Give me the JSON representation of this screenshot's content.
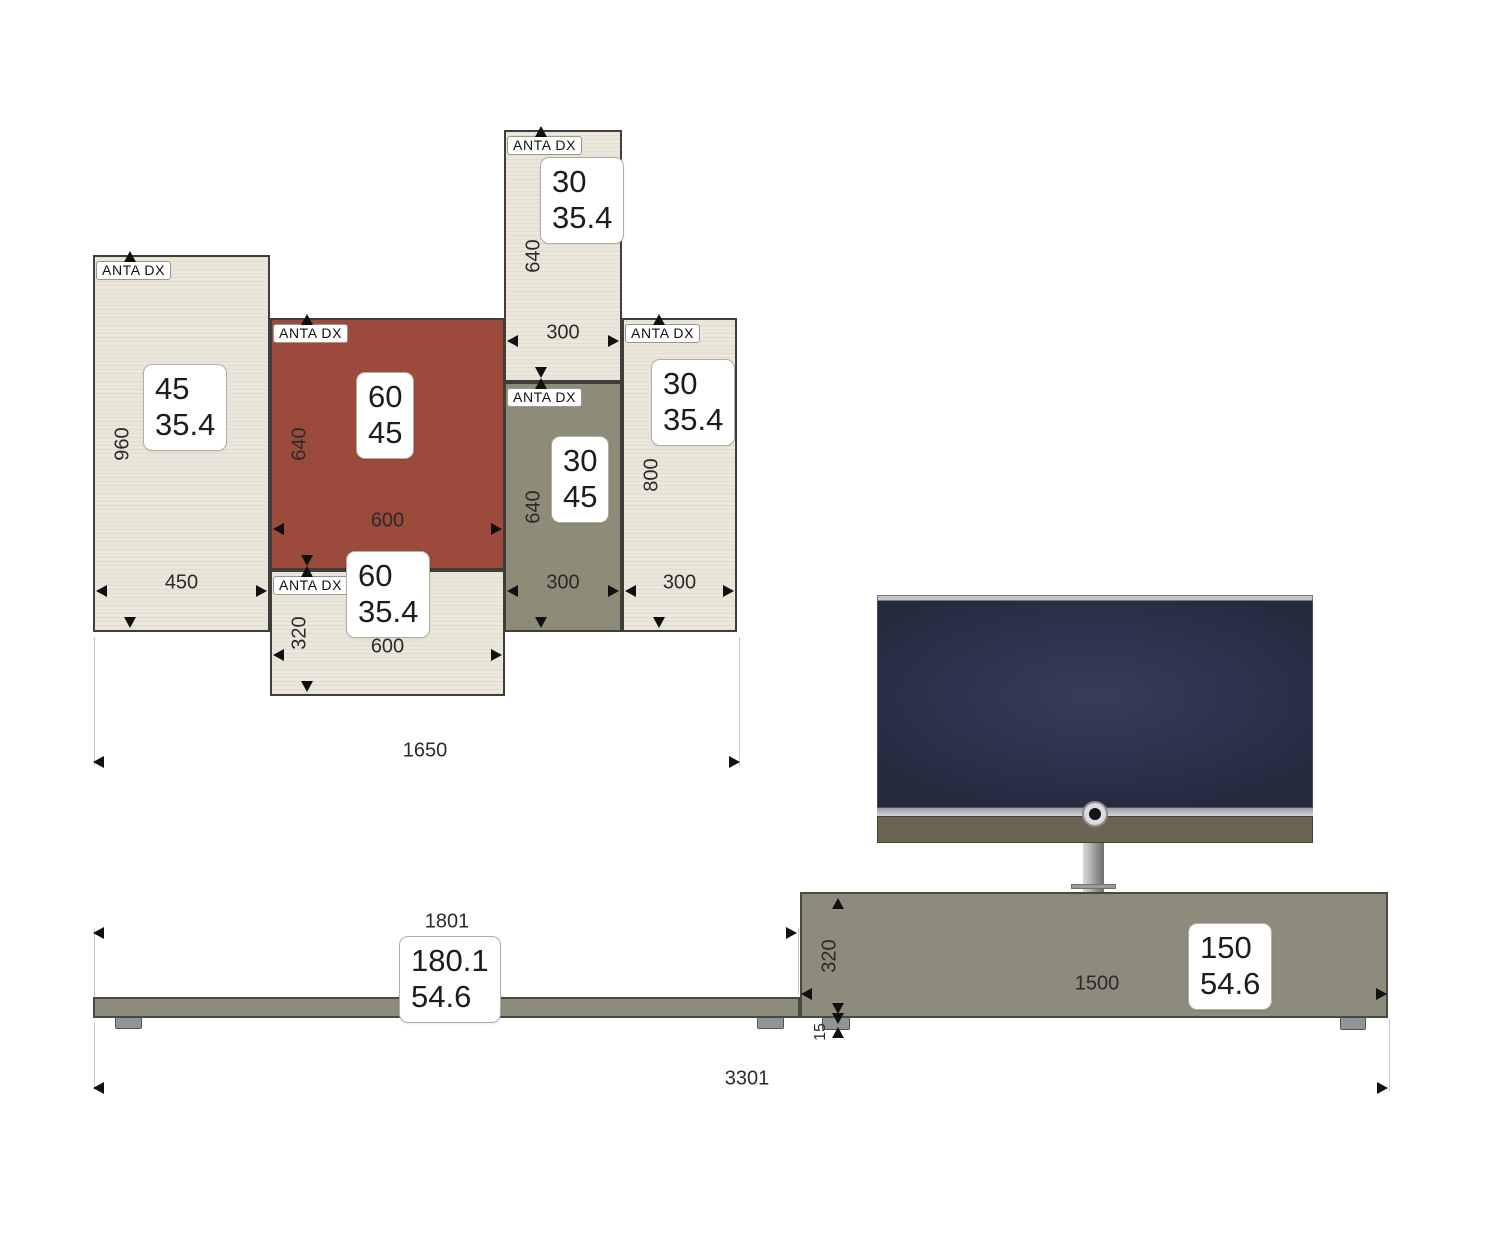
{
  "drawing": {
    "kind": "furniture-elevation"
  },
  "colors": {
    "cream": "#eae6da",
    "red": "#9b4a3c",
    "olive": "#8e8b78",
    "unit_gray": "#8d8b7b",
    "outline": "#3f3e38",
    "dim_text": "#2b2b2b",
    "arrow": "#111111",
    "ext_line": "#c6c6c6",
    "tv_screen": "#2d334c",
    "tv_trim": "#c3c6cb",
    "soundbar": "#6b6452",
    "foot": "#90959a",
    "label_bg": "#ffffff"
  },
  "panels": [
    {
      "tag": "ANTA DX",
      "size_top": "45",
      "size_bottom": "35.4",
      "height_dim": "960",
      "width_dim": "450",
      "fill": "cream",
      "geom": {
        "x": 93,
        "y": 255,
        "w": 177,
        "h": 377,
        "bx": 143,
        "by": 364
      }
    },
    {
      "tag": "ANTA DX",
      "size_top": "60",
      "size_bottom": "45",
      "height_dim": "640",
      "width_dim": "600",
      "fill": "red",
      "geom": {
        "x": 270,
        "y": 318,
        "w": 235,
        "h": 252,
        "bx": 356,
        "by": 372
      }
    },
    {
      "tag": "ANTA DX",
      "size_top": "30",
      "size_bottom": "35.4",
      "height_dim": "640",
      "width_dim": "300",
      "fill": "cream",
      "geom": {
        "x": 504,
        "y": 130,
        "w": 118,
        "h": 252,
        "bx": 540,
        "by": 157
      }
    },
    {
      "tag": "ANTA DX",
      "size_top": "30",
      "size_bottom": "45",
      "height_dim": "640",
      "width_dim": "300",
      "fill": "olive",
      "geom": {
        "x": 504,
        "y": 382,
        "w": 118,
        "h": 250,
        "bx": 551,
        "by": 436
      }
    },
    {
      "tag": "ANTA DX",
      "size_top": "30",
      "size_bottom": "35.4",
      "height_dim": "800",
      "width_dim": "300",
      "fill": "cream",
      "geom": {
        "x": 622,
        "y": 318,
        "w": 115,
        "h": 314,
        "bx": 651,
        "by": 359
      }
    },
    {
      "tag": "ANTA DX",
      "size_top": "60",
      "size_bottom": "35.4",
      "height_dim": "320",
      "width_dim": "600",
      "fill": "cream",
      "geom": {
        "x": 270,
        "y": 570,
        "w": 235,
        "h": 126,
        "bx": 346,
        "by": 551
      }
    }
  ],
  "upper_assembly": {
    "width_dim": "1650"
  },
  "base": {
    "bench": {
      "width_dim": "1801",
      "size_top": "180.1",
      "size_bottom": "54.6"
    },
    "tv_unit": {
      "width_dim": "1500",
      "size_top": "150",
      "size_bottom": "54.6",
      "height_dim": "320",
      "foot_dim": "15"
    },
    "total_width_dim": "3301"
  }
}
